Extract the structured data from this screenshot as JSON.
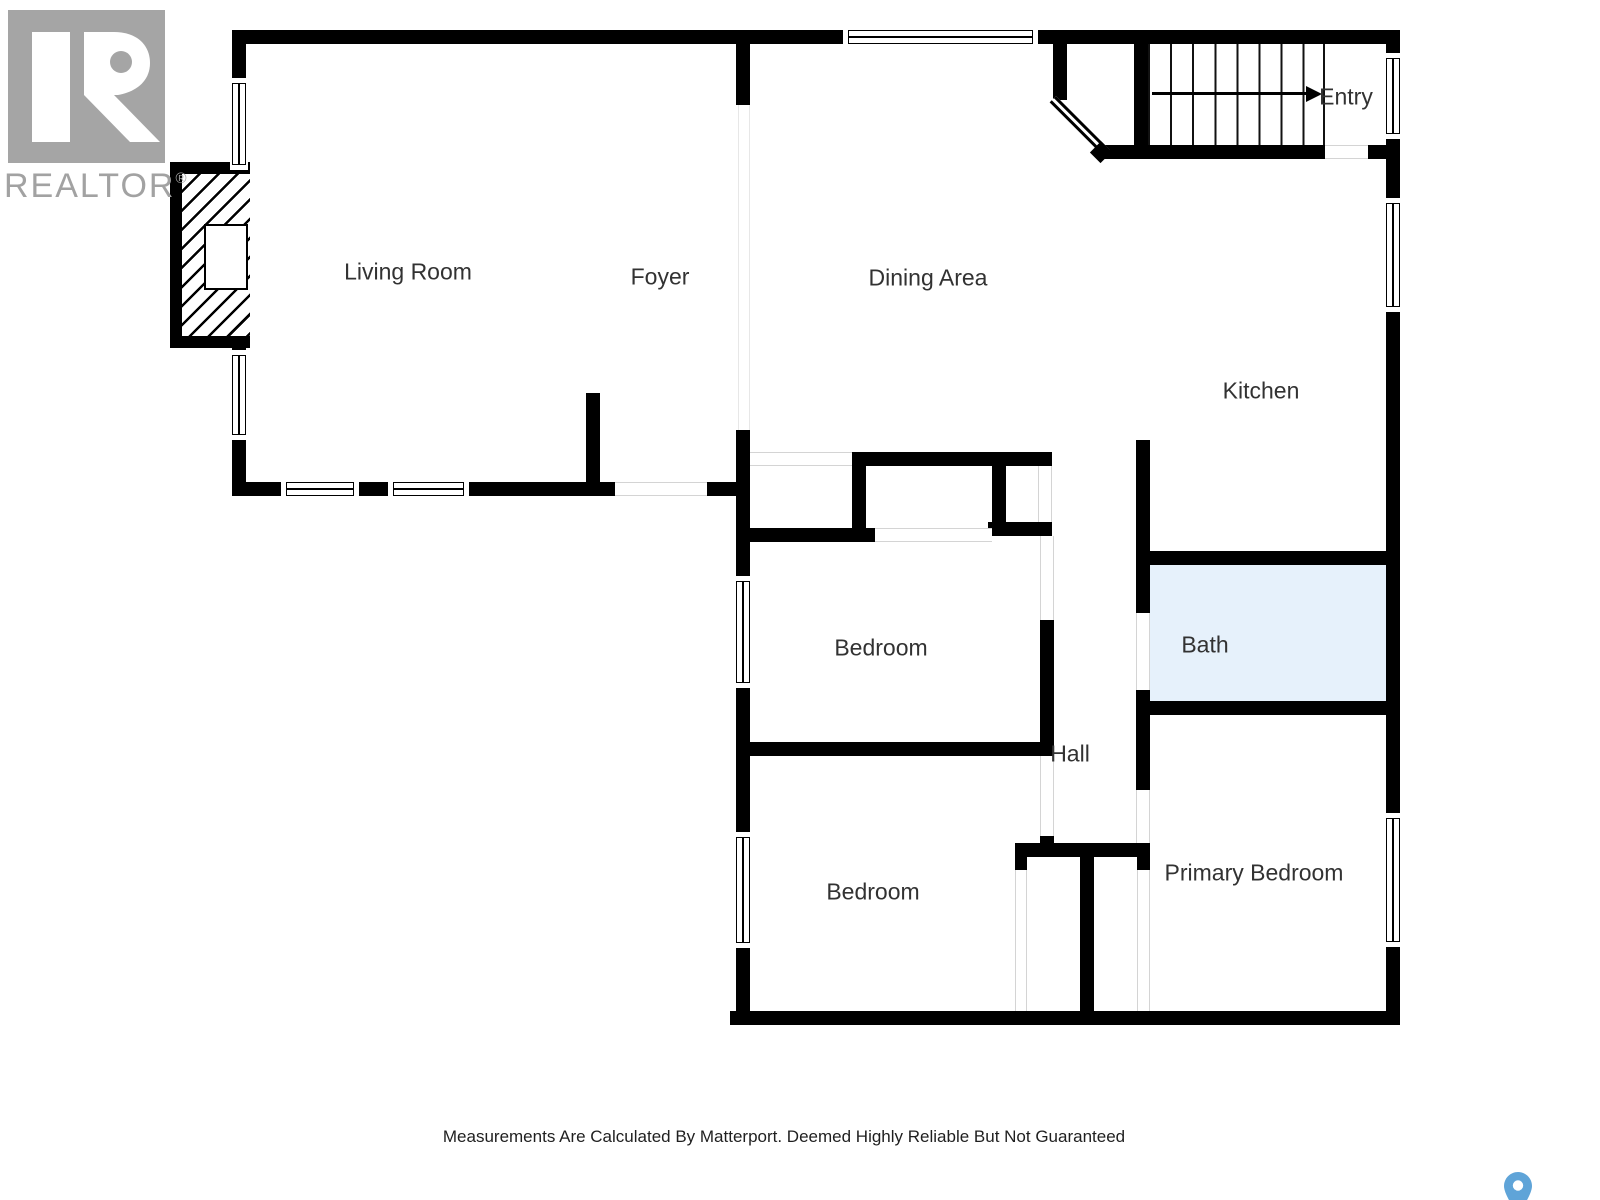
{
  "branding": {
    "logo_letter": "R",
    "wordmark": "REALTOR",
    "registered_mark": "®"
  },
  "rooms": [
    {
      "id": "living-room",
      "label": "Living Room"
    },
    {
      "id": "foyer",
      "label": "Foyer"
    },
    {
      "id": "dining-area",
      "label": "Dining Area"
    },
    {
      "id": "entry",
      "label": "Entry"
    },
    {
      "id": "kitchen",
      "label": "Kitchen"
    },
    {
      "id": "bedroom-1",
      "label": "Bedroom"
    },
    {
      "id": "bath",
      "label": "Bath"
    },
    {
      "id": "hall",
      "label": "Hall"
    },
    {
      "id": "bedroom-2",
      "label": "Bedroom"
    },
    {
      "id": "primary-bedroom",
      "label": "Primary Bedroom"
    }
  ],
  "floor_plan": {
    "stairs": {
      "treads": 9,
      "arrow_direction": "right"
    },
    "highlighted_room": "bath"
  },
  "footer": {
    "disclaimer": "Measurements Are Calculated By Matterport. Deemed Highly Reliable But Not Guaranteed"
  },
  "icons": [
    {
      "name": "realtor-logo"
    },
    {
      "name": "stairs-direction-arrow"
    },
    {
      "name": "location-pin-icon"
    }
  ],
  "colors": {
    "wall": "#000000",
    "bath_fill": "#e6f1fb",
    "logo_gray": "#a5a5a5",
    "wordmark_gray": "#a2a2a2",
    "pin_blue": "#5fa4d8",
    "label_text": "#323232"
  }
}
